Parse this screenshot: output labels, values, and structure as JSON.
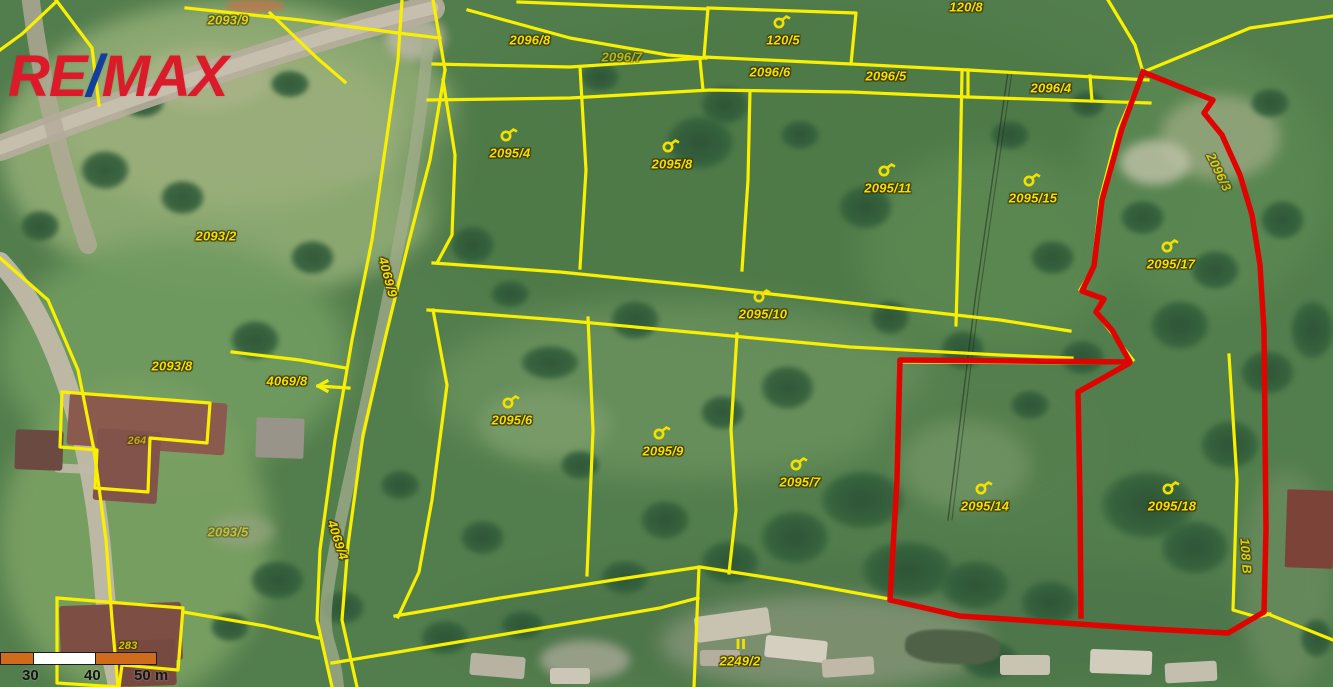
{
  "branding": {
    "re": "RE",
    "slash": "/",
    "max": "MAX"
  },
  "scale_bar": {
    "labels": [
      "30",
      "40",
      "50 m"
    ]
  },
  "highlighted_parcels": [
    "2095/17",
    "2095/14",
    "2095/18"
  ],
  "colors": {
    "logo_red": "#dc1b2a",
    "logo_blue": "#123f9e",
    "parcel_label": "#f2e100",
    "boundary_yellow": "#f8f000",
    "highlight_red": "#df0400",
    "scale_orange": "#cf6c1c",
    "scale_white": "#ffffff"
  },
  "parcel_labels": [
    {
      "t": "2093/9",
      "x": 228,
      "y": 20,
      "o": 0.75
    },
    {
      "t": "2096/8",
      "x": 530,
      "y": 40
    },
    {
      "t": "2096/7",
      "x": 622,
      "y": 57,
      "o": 0.6
    },
    {
      "t": "120/5",
      "x": 783,
      "y": 40,
      "sym": "p"
    },
    {
      "t": "120/8",
      "x": 966,
      "y": 7
    },
    {
      "t": "2096/6",
      "x": 770,
      "y": 72
    },
    {
      "t": "2096/5",
      "x": 886,
      "y": 76
    },
    {
      "t": "2096/4",
      "x": 1051,
      "y": 88
    },
    {
      "t": "2095/4",
      "x": 510,
      "y": 153,
      "sym": "p"
    },
    {
      "t": "2095/8",
      "x": 672,
      "y": 164,
      "sym": "p"
    },
    {
      "t": "2095/11",
      "x": 888,
      "y": 188,
      "sym": "p"
    },
    {
      "t": "2095/15",
      "x": 1033,
      "y": 198,
      "sym": "p"
    },
    {
      "t": "2096/3",
      "x": 1219,
      "y": 172,
      "r": 64,
      "o": 0.7
    },
    {
      "t": "2095/17",
      "x": 1171,
      "y": 264,
      "sym": "p"
    },
    {
      "t": "2093/2",
      "x": 216,
      "y": 236
    },
    {
      "t": "4069/9",
      "x": 388,
      "y": 277,
      "r": 75
    },
    {
      "t": "2095/10",
      "x": 763,
      "y": 314,
      "sym": "p"
    },
    {
      "t": "2093/8",
      "x": 172,
      "y": 366
    },
    {
      "t": "4069/8",
      "x": 287,
      "y": 381
    },
    {
      "t": "2095/6",
      "x": 512,
      "y": 420,
      "sym": "p"
    },
    {
      "t": "264",
      "x": 137,
      "y": 441,
      "o": 0.6,
      "s": 11
    },
    {
      "t": "2095/9",
      "x": 663,
      "y": 451,
      "sym": "p"
    },
    {
      "t": "2095/7",
      "x": 800,
      "y": 482,
      "sym": "p"
    },
    {
      "t": "2095/14",
      "x": 985,
      "y": 506,
      "sym": "p"
    },
    {
      "t": "2095/18",
      "x": 1172,
      "y": 506,
      "sym": "p"
    },
    {
      "t": "2093/5",
      "x": 228,
      "y": 532,
      "o": 0.5
    },
    {
      "t": "4069/4",
      "x": 338,
      "y": 540,
      "r": 72
    },
    {
      "t": "108 B",
      "x": 1246,
      "y": 556,
      "r": 86,
      "o": 0.8
    },
    {
      "t": "283",
      "x": 128,
      "y": 646,
      "o": 0.8,
      "s": 11
    },
    {
      "t": "2249/2",
      "x": 740,
      "y": 661,
      "sym": "bars"
    }
  ],
  "lines": {
    "yellow": [
      [
        [
          56,
          0
        ],
        [
          92,
          48
        ],
        [
          99,
          105
        ]
      ],
      [
        [
          56,
          2
        ],
        [
          22,
          34
        ],
        [
          0,
          50
        ]
      ],
      [
        [
          186,
          8
        ],
        [
          300,
          20
        ],
        [
          398,
          33
        ],
        [
          440,
          38
        ]
      ],
      [
        [
          270,
          13
        ],
        [
          317,
          58
        ],
        [
          345,
          82
        ]
      ],
      [
        [
          468,
          10
        ],
        [
          570,
          38
        ],
        [
          668,
          55
        ],
        [
          706,
          58
        ]
      ],
      [
        [
          518,
          2
        ],
        [
          620,
          6
        ],
        [
          708,
          9
        ]
      ],
      [
        [
          708,
          8
        ],
        [
          856,
          13
        ],
        [
          851,
          64
        ],
        [
          704,
          57
        ],
        [
          708,
          8
        ]
      ],
      [
        [
          433,
          64
        ],
        [
          570,
          67
        ],
        [
          704,
          58
        ]
      ],
      [
        [
          851,
          64
        ],
        [
          968,
          70
        ],
        [
          1148,
          80
        ]
      ],
      [
        [
          428,
          100
        ],
        [
          570,
          98
        ],
        [
          710,
          90
        ],
        [
          851,
          92
        ],
        [
          968,
          97
        ],
        [
          1150,
          103
        ]
      ],
      [
        [
          968,
          70
        ],
        [
          968,
          97
        ]
      ],
      [
        [
          700,
          60
        ],
        [
          703,
          90
        ]
      ],
      [
        [
          1090,
          76
        ],
        [
          1092,
          101
        ]
      ],
      [
        [
          433,
          0
        ],
        [
          445,
          70
        ]
      ],
      [
        [
          402,
          0
        ],
        [
          398,
          60
        ],
        [
          385,
          150
        ],
        [
          372,
          240
        ],
        [
          352,
          340
        ],
        [
          335,
          440
        ],
        [
          320,
          550
        ],
        [
          317,
          620
        ],
        [
          332,
          687
        ]
      ],
      [
        [
          445,
          70
        ],
        [
          430,
          160
        ],
        [
          408,
          245
        ],
        [
          386,
          335
        ],
        [
          363,
          435
        ],
        [
          348,
          545
        ],
        [
          342,
          620
        ],
        [
          357,
          687
        ]
      ],
      [
        [
          443,
          80
        ],
        [
          455,
          155
        ],
        [
          452,
          235
        ],
        [
          437,
          263
        ]
      ],
      [
        [
          433,
          310
        ],
        [
          447,
          385
        ],
        [
          432,
          500
        ],
        [
          419,
          572
        ],
        [
          398,
          617
        ]
      ],
      [
        [
          433,
          263
        ],
        [
          560,
          272
        ],
        [
          700,
          286
        ],
        [
          850,
          303
        ],
        [
          1000,
          320
        ],
        [
          1070,
          331
        ]
      ],
      [
        [
          428,
          310
        ],
        [
          560,
          320
        ],
        [
          700,
          333
        ],
        [
          850,
          347
        ],
        [
          1000,
          355
        ],
        [
          1072,
          358
        ]
      ],
      [
        [
          580,
          67
        ],
        [
          586,
          170
        ],
        [
          580,
          268
        ]
      ],
      [
        [
          750,
          91
        ],
        [
          748,
          180
        ],
        [
          742,
          270
        ]
      ],
      [
        [
          962,
          72
        ],
        [
          960,
          180
        ],
        [
          956,
          325
        ]
      ],
      [
        [
          1108,
          0
        ],
        [
          1135,
          45
        ],
        [
          1143,
          72
        ]
      ],
      [
        [
          1143,
          72
        ],
        [
          1250,
          28
        ],
        [
          1333,
          16
        ]
      ],
      [
        [
          1143,
          72
        ],
        [
          1118,
          130
        ],
        [
          1100,
          200
        ],
        [
          1093,
          268
        ],
        [
          1080,
          290
        ],
        [
          1103,
          300
        ],
        [
          1097,
          314
        ],
        [
          1133,
          360
        ]
      ],
      [
        [
          588,
          318
        ],
        [
          593,
          430
        ],
        [
          587,
          575
        ]
      ],
      [
        [
          737,
          334
        ],
        [
          731,
          430
        ],
        [
          736,
          510
        ],
        [
          729,
          573
        ]
      ],
      [
        [
          395,
          616
        ],
        [
          500,
          598
        ],
        [
          620,
          579
        ],
        [
          700,
          567
        ],
        [
          790,
          581
        ],
        [
          895,
          600
        ]
      ],
      [
        [
          332,
          663
        ],
        [
          440,
          645
        ],
        [
          560,
          625
        ],
        [
          660,
          608
        ],
        [
          698,
          598
        ]
      ],
      [
        [
          699,
          567
        ],
        [
          694,
          687
        ]
      ],
      [
        [
          1268,
          614
        ],
        [
          1333,
          640
        ]
      ],
      [
        [
          1229,
          355
        ],
        [
          1237,
          480
        ],
        [
          1233,
          610
        ],
        [
          1257,
          617
        ],
        [
          1270,
          614
        ]
      ],
      [
        [
          902,
          362
        ],
        [
          1130,
          363
        ]
      ],
      [
        [
          232,
          352
        ],
        [
          300,
          360
        ],
        [
          346,
          368
        ]
      ],
      [
        [
          62,
          392
        ],
        [
          210,
          403
        ],
        [
          207,
          443
        ],
        [
          150,
          438
        ],
        [
          148,
          492
        ],
        [
          95,
          488
        ],
        [
          97,
          450
        ],
        [
          60,
          447
        ],
        [
          62,
          392
        ]
      ],
      [
        [
          57,
          598
        ],
        [
          183,
          608
        ],
        [
          178,
          670
        ],
        [
          122,
          665
        ],
        [
          119,
          687
        ],
        [
          57,
          683
        ],
        [
          57,
          598
        ]
      ],
      [
        [
          183,
          612
        ],
        [
          265,
          626
        ],
        [
          318,
          638
        ]
      ],
      [
        [
          0,
          258
        ],
        [
          48,
          300
        ],
        [
          78,
          370
        ],
        [
          94,
          450
        ],
        [
          106,
          540
        ],
        [
          112,
          620
        ],
        [
          118,
          687
        ]
      ],
      [
        [
          349,
          388
        ],
        [
          318,
          386
        ]
      ],
      [
        [
          318,
          386
        ],
        [
          327,
          381
        ]
      ],
      [
        [
          318,
          386
        ],
        [
          327,
          391
        ]
      ]
    ],
    "red": [
      [
        [
          1143,
          72
        ],
        [
          1213,
          100
        ],
        [
          1204,
          113
        ],
        [
          1222,
          135
        ],
        [
          1240,
          175
        ],
        [
          1252,
          215
        ],
        [
          1260,
          265
        ],
        [
          1264,
          330
        ],
        [
          1265,
          430
        ],
        [
          1266,
          530
        ],
        [
          1264,
          612
        ],
        [
          1228,
          633
        ],
        [
          1150,
          629
        ],
        [
          1050,
          622
        ],
        [
          960,
          616
        ],
        [
          890,
          600
        ],
        [
          897,
          480
        ],
        [
          900,
          360
        ],
        [
          1130,
          362
        ],
        [
          1112,
          330
        ],
        [
          1096,
          312
        ],
        [
          1104,
          299
        ],
        [
          1082,
          291
        ],
        [
          1094,
          266
        ],
        [
          1102,
          200
        ],
        [
          1122,
          128
        ],
        [
          1143,
          72
        ]
      ],
      [
        [
          1128,
          364
        ],
        [
          1078,
          392
        ],
        [
          1080,
          500
        ],
        [
          1081,
          616
        ]
      ]
    ]
  }
}
